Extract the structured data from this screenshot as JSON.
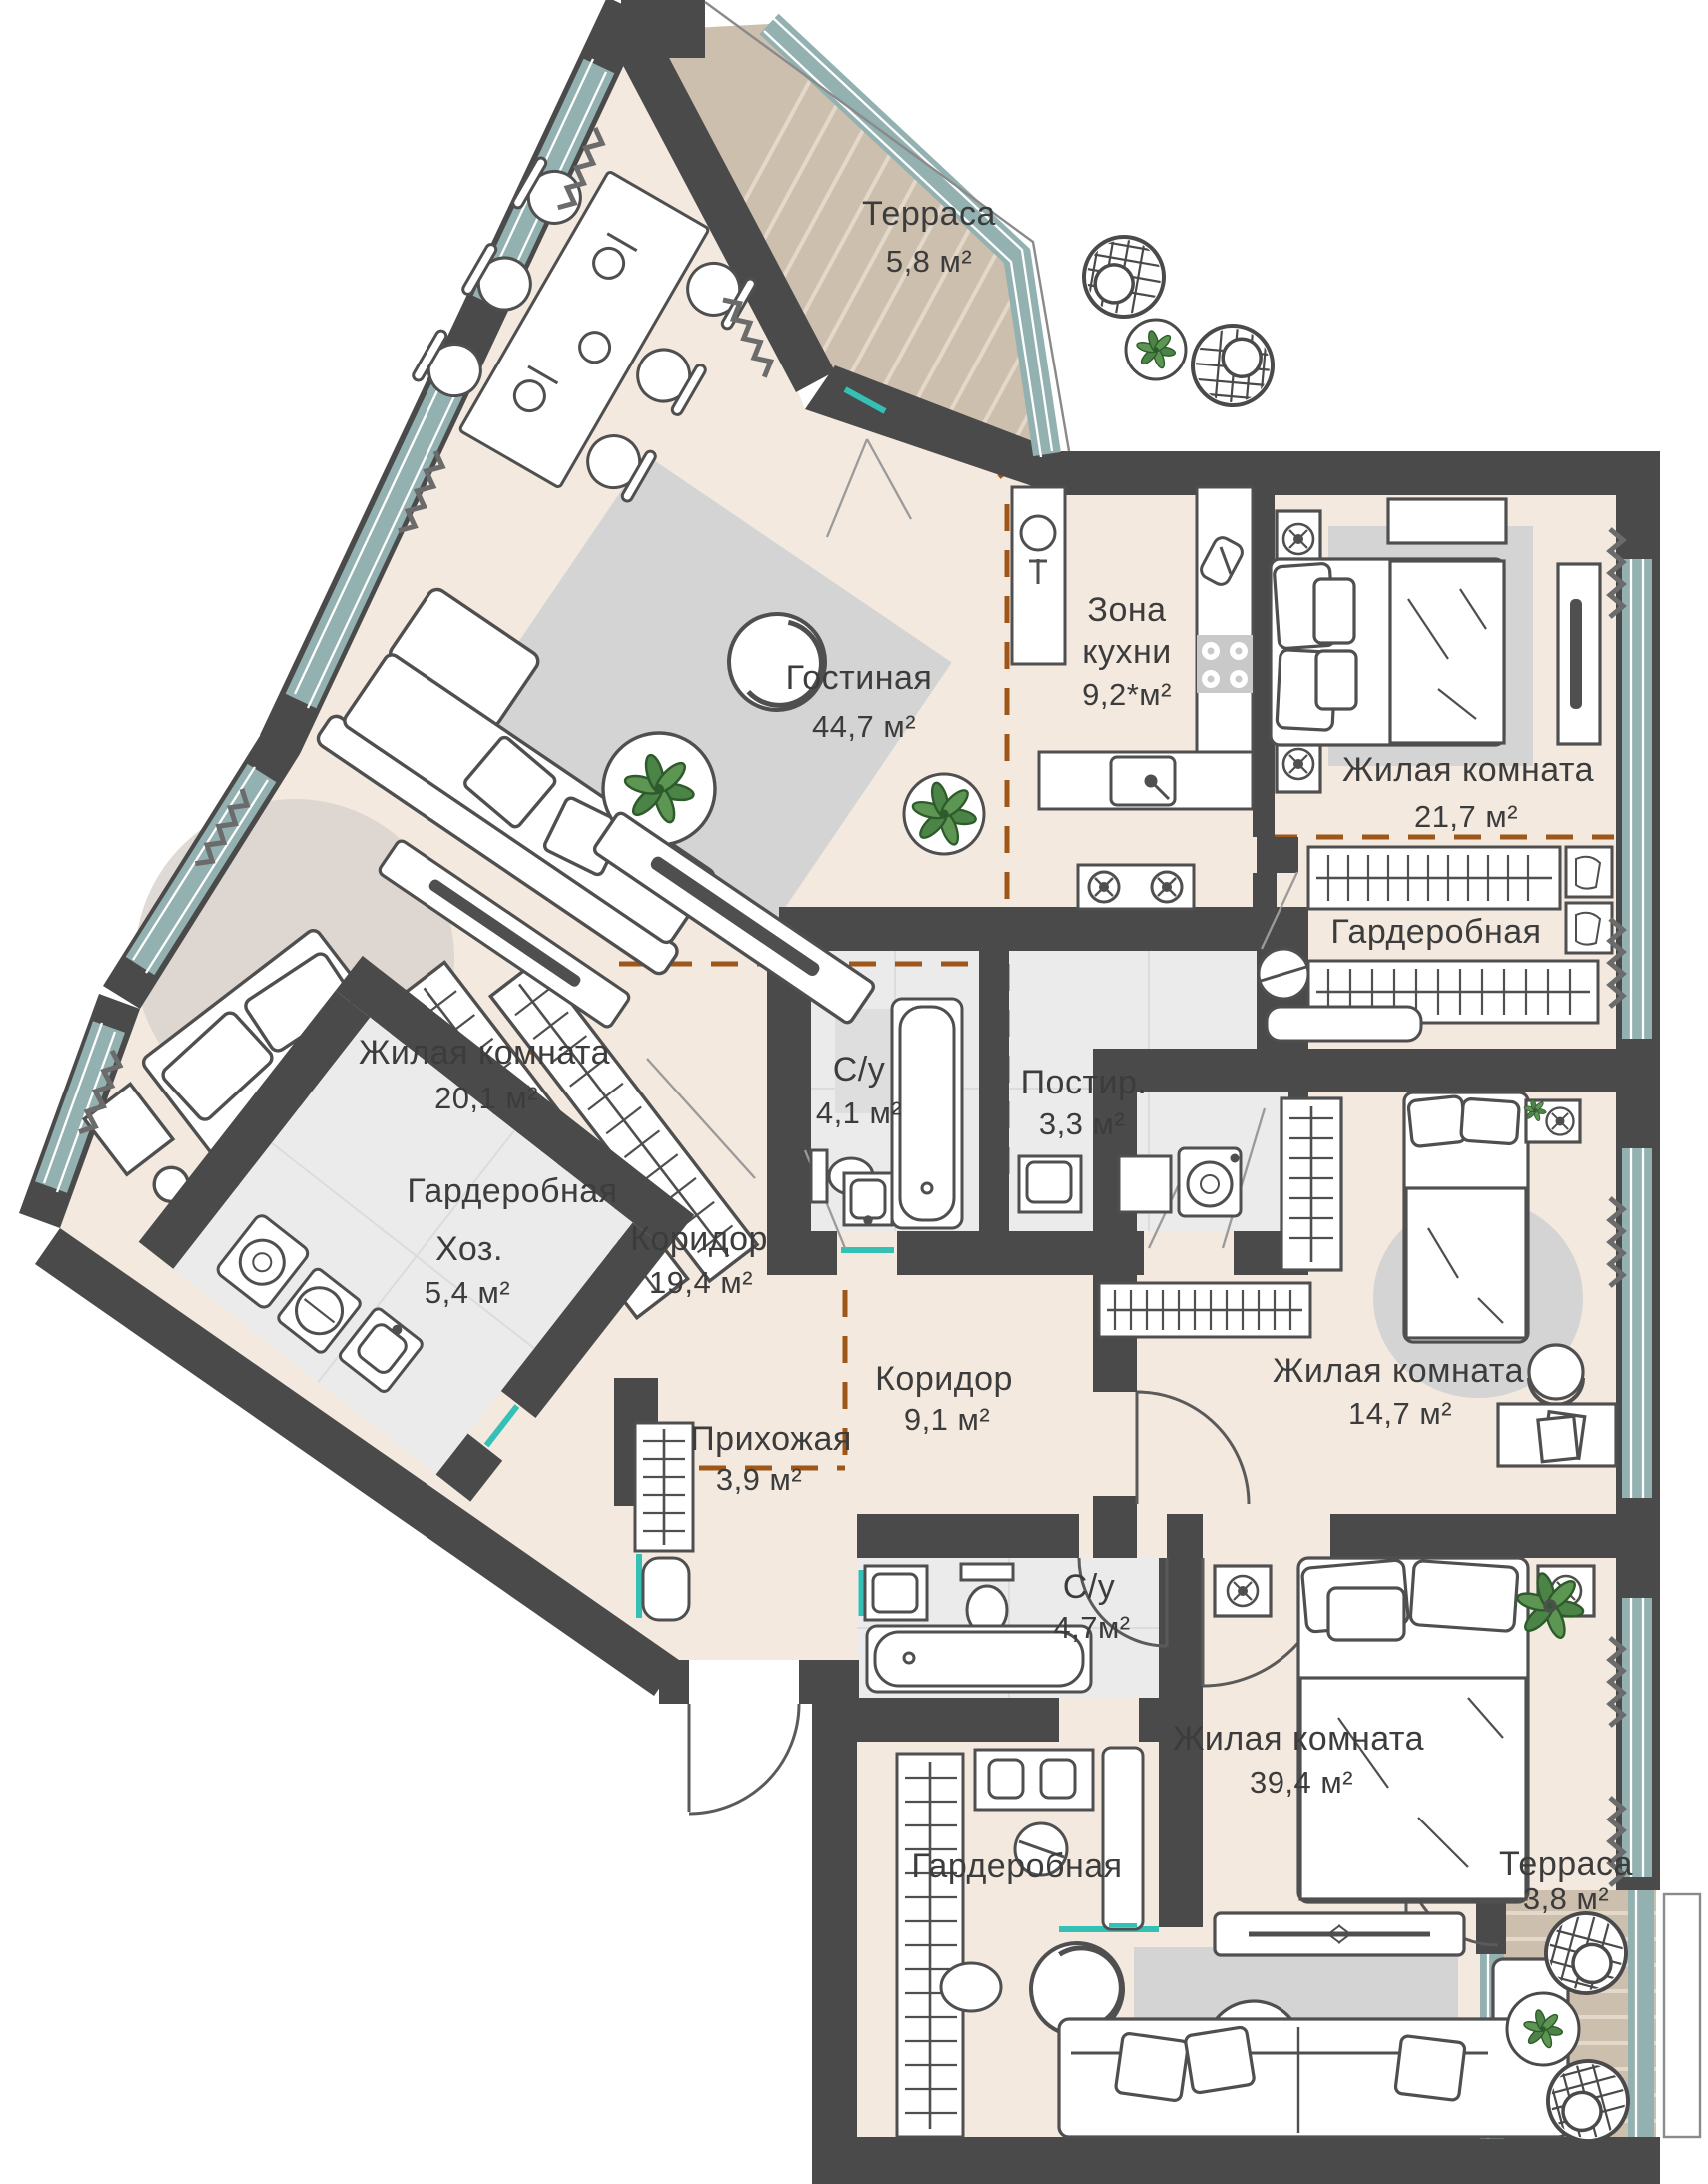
{
  "plan": {
    "type": "apartment-floor-plan",
    "language": "ru",
    "rooms": [
      {
        "id": "terrace-top",
        "name": "Терраса",
        "area": "5,8 м²"
      },
      {
        "id": "living-room",
        "name": "Гостиная",
        "area": "44,7 м²"
      },
      {
        "id": "kitchen-zone",
        "name1": "Зона",
        "name2": "кухни",
        "area": "9,2*м²"
      },
      {
        "id": "bedroom-21",
        "name": "Жилая комната",
        "area": "21,7 м²"
      },
      {
        "id": "wardrobe-right",
        "name": "Гардеробная"
      },
      {
        "id": "bedroom-20",
        "name": "Жилая комната",
        "area": "20,1 м²"
      },
      {
        "id": "wardrobe-left",
        "name": "Гардеробная"
      },
      {
        "id": "bath-small",
        "name": "С/у",
        "area": "4,1 м²"
      },
      {
        "id": "laundry",
        "name": "Постир.",
        "area": "3,3 м²"
      },
      {
        "id": "corridor-main",
        "name": "Коридор",
        "area": "19,4 м²"
      },
      {
        "id": "utility",
        "name": "Хоз.",
        "area": "5,4 м²"
      },
      {
        "id": "corridor-small",
        "name": "Коридор",
        "area": "9,1 м²"
      },
      {
        "id": "hallway",
        "name": "Прихожая",
        "area": "3,9 м²"
      },
      {
        "id": "bath-large",
        "name": "С/у",
        "area": "4,7м²"
      },
      {
        "id": "bedroom-14",
        "name": "Жилая комната",
        "area": "14,7 м²"
      },
      {
        "id": "wardrobe-bottom",
        "name": "Гардеробная"
      },
      {
        "id": "bedroom-39",
        "name": "Жилая комната",
        "area": "39,4 м²"
      },
      {
        "id": "terrace-bottom",
        "name": "Терраса",
        "area": "3,8 м²"
      }
    ],
    "colors": {
      "wall": "#4a4a4a",
      "floor": "#f3e9df",
      "terrace_floor": "#cdbfae",
      "terrace_stripe": "#e3d8c9",
      "wet_floor": "#ebebeb",
      "rug": "#d4d4d4",
      "glazing": "#92b1b0",
      "zone_dashed": "#9e5718",
      "door_threshold": "#35c0b5",
      "furniture_stroke": "#4f4f4f",
      "plant": "#4c8347"
    }
  }
}
